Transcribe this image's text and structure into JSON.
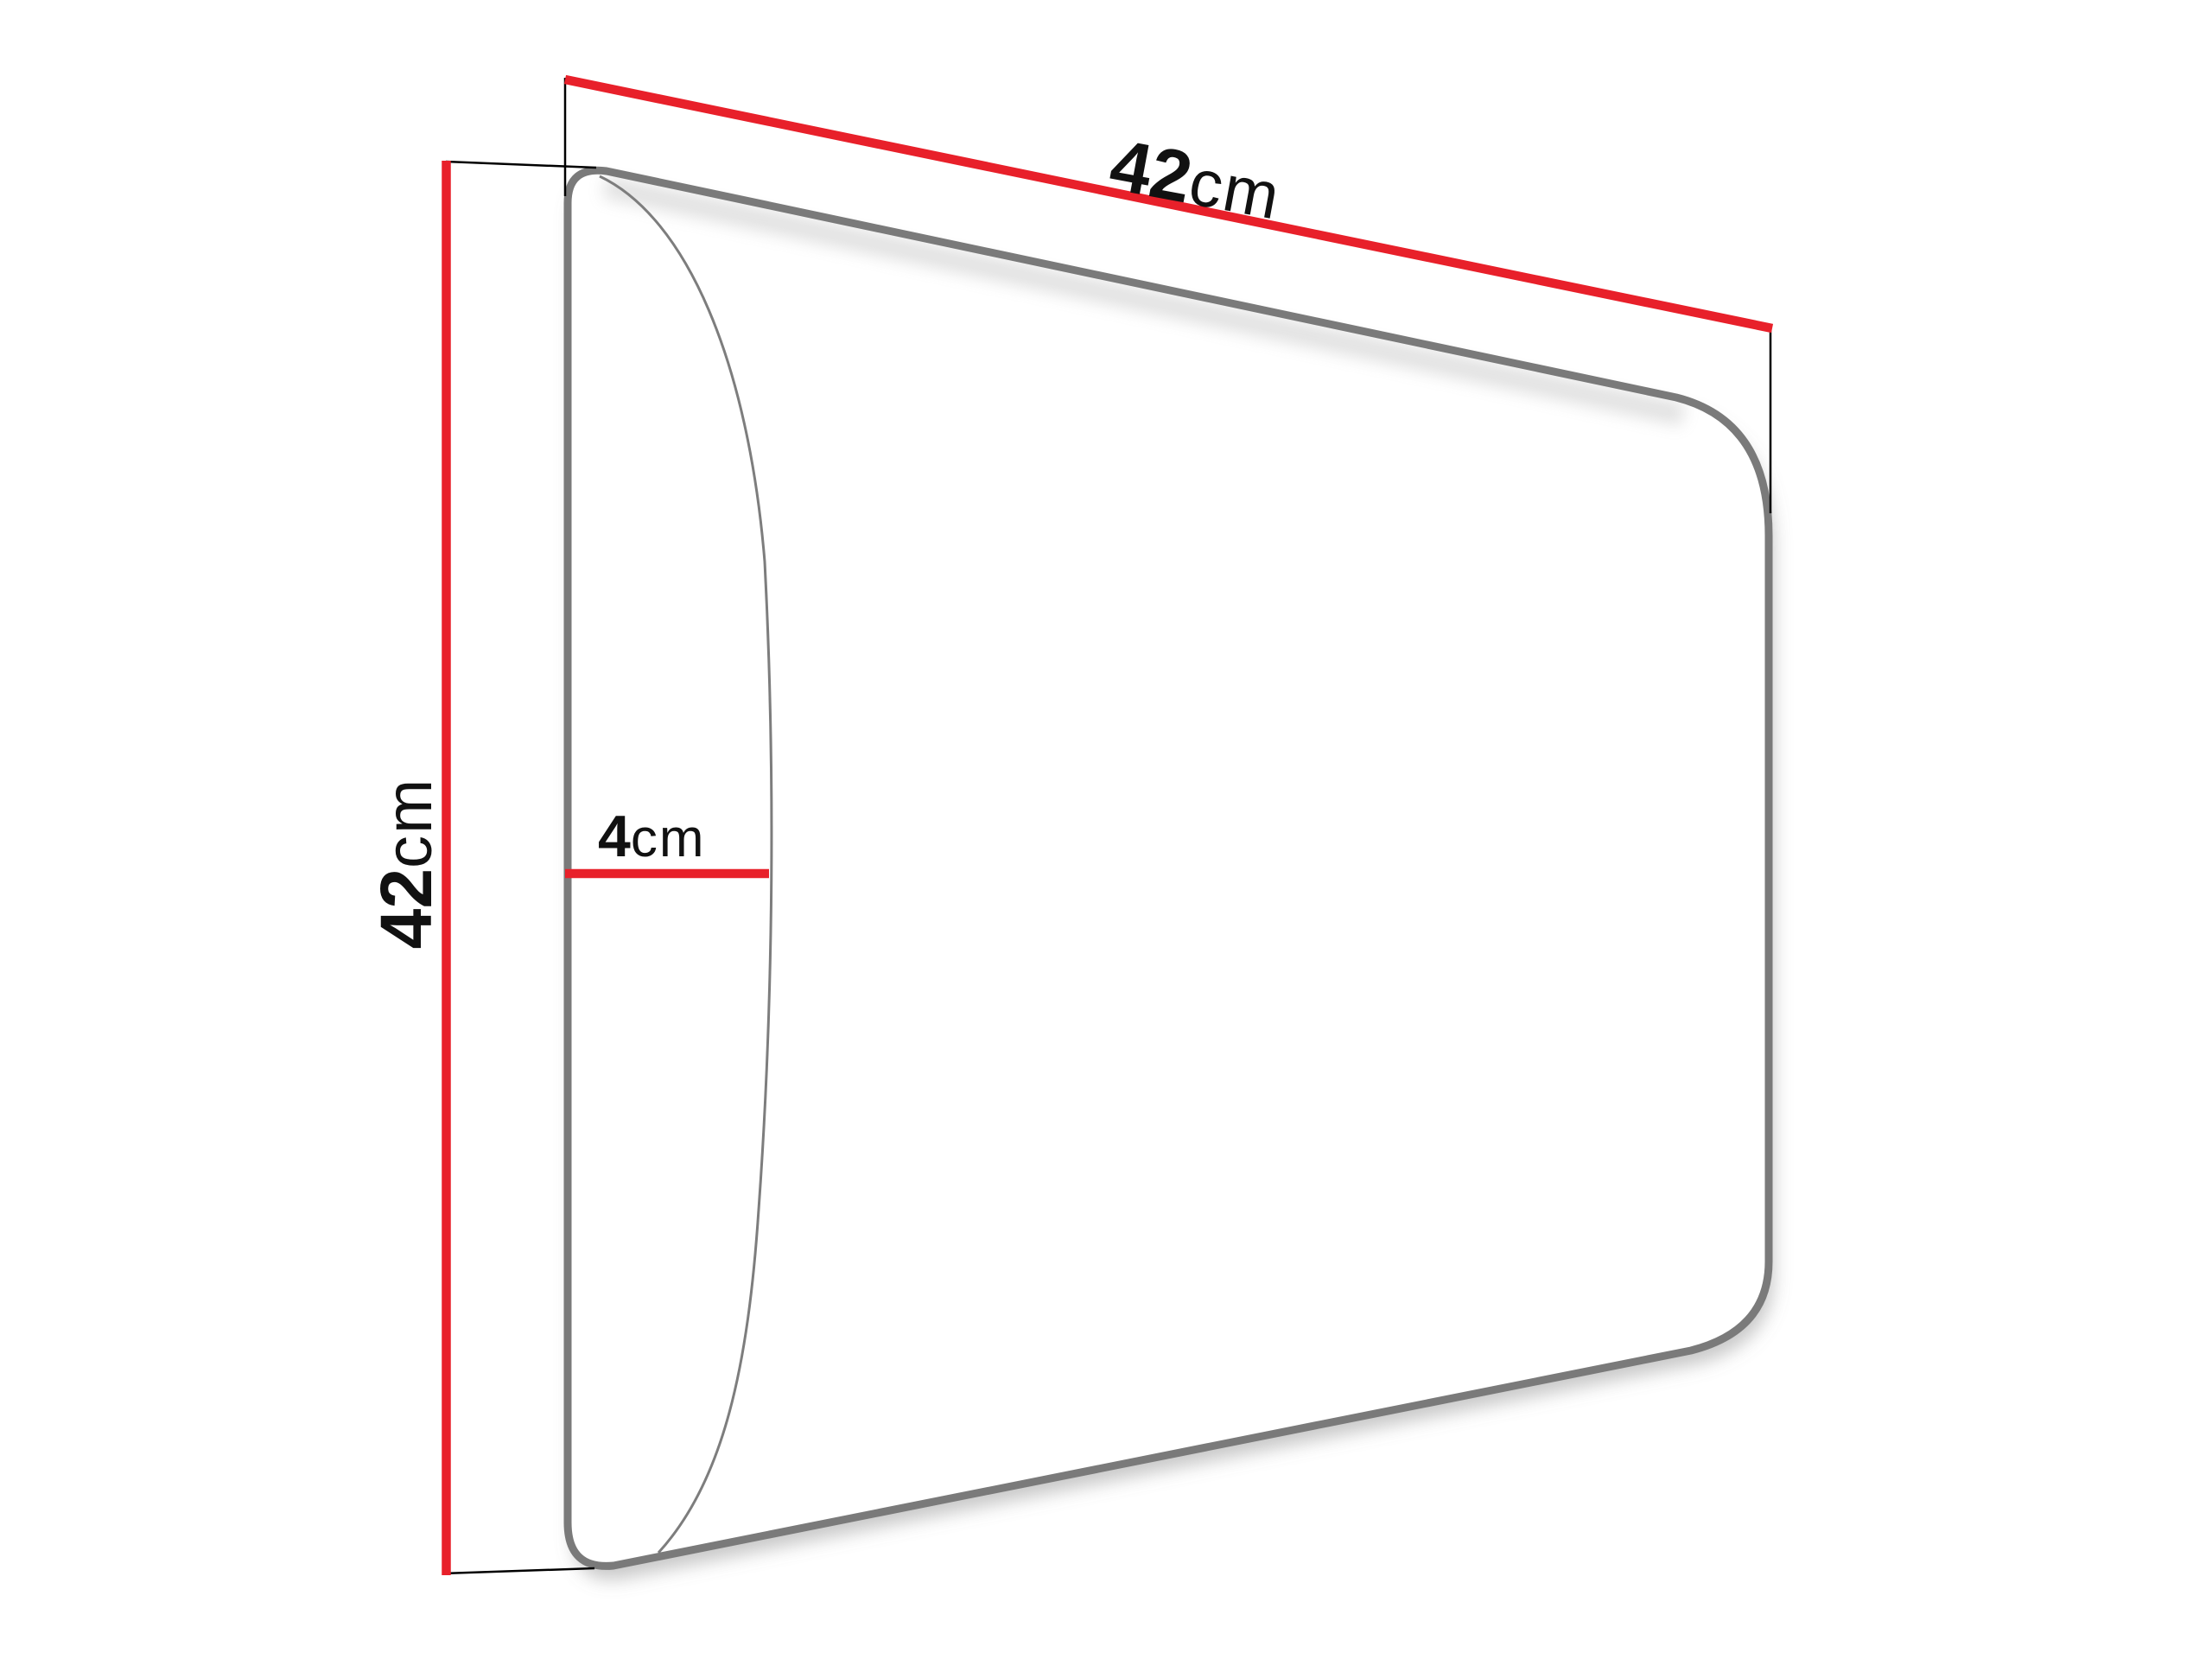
{
  "diagram": {
    "kind": "dimension-diagram",
    "dimensions": {
      "width": {
        "value": "42",
        "unit": "cm"
      },
      "height": {
        "value": "42",
        "unit": "cm"
      },
      "depth": {
        "value": "4",
        "unit": "cm"
      }
    },
    "colors": {
      "dimension_line": "#e8202a",
      "extension_line": "#000000",
      "panel_outline": "#7a7a7a",
      "panel_edge_curve": "#7d7d7d",
      "label_text": "#111111",
      "background": "#ffffff"
    }
  }
}
